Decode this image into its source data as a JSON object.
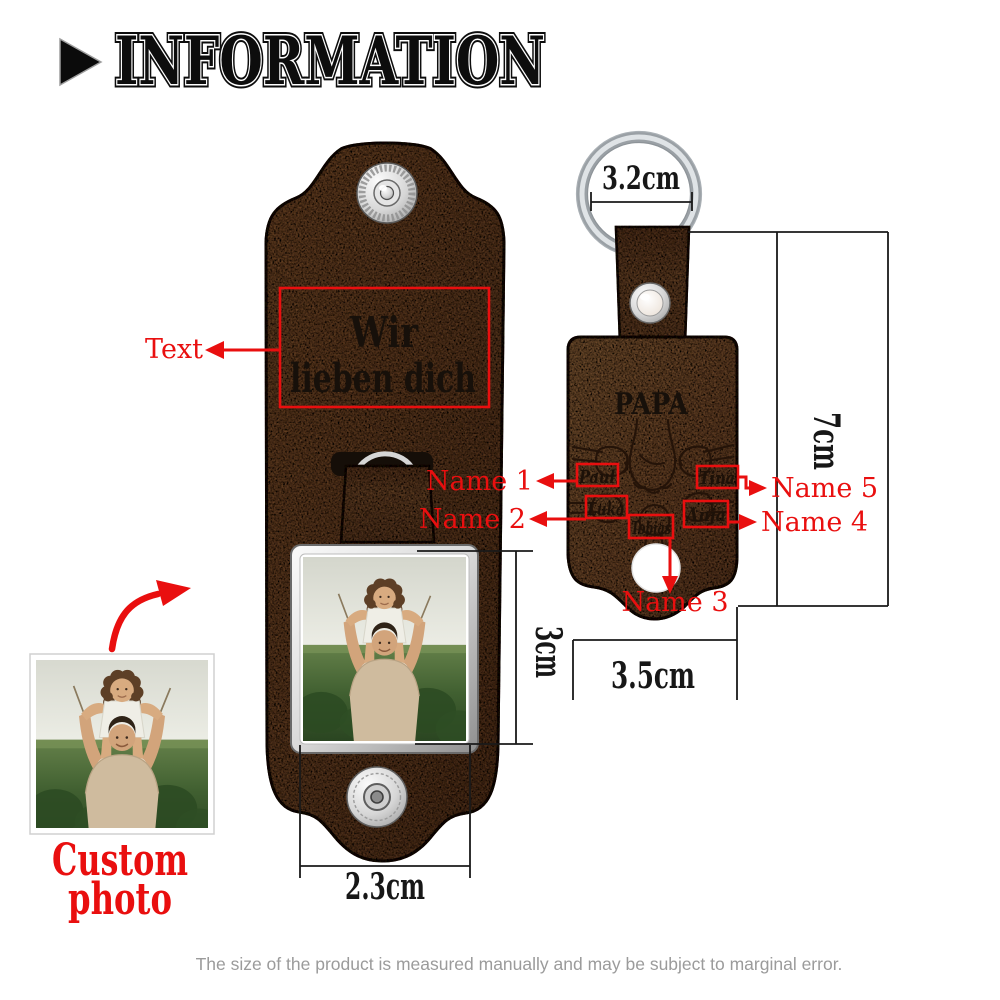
{
  "header": {
    "title": "INFORMATION"
  },
  "left_keychain": {
    "engraved_text": {
      "line1": "Wir",
      "line2": "lieben dich"
    },
    "annotations": {
      "text_label": "Text",
      "custom_photo_line1": "Custom",
      "custom_photo_line2": "photo"
    },
    "dimensions": {
      "photo_height": "3cm",
      "photo_width": "2.3cm"
    }
  },
  "right_keychain": {
    "engraved_title": "PAPA",
    "names": [
      "Paul",
      "Luka",
      "Tobias",
      "Anja",
      "Tina"
    ],
    "annotations": {
      "name1": "Name 1",
      "name2": "Name 2",
      "name3": "Name 3",
      "name4": "Name 4",
      "name5": "Name 5"
    },
    "dimensions": {
      "ring_diameter": "3.2cm",
      "height": "7cm",
      "width": "3.5cm"
    }
  },
  "footer": {
    "disclaimer": "The size of the product is measured manually and may be subject to marginal error."
  },
  "colors": {
    "annotation_red": "#e90f0f",
    "leather_left": "#7a4e2d",
    "leather_right": "#8a5c38",
    "engraving_dark": "#1d1007",
    "metal_silver": "#c9cdd1",
    "dimension_line": "#1a1a1a",
    "disclaimer_gray": "#9b9b9b"
  },
  "icons": {
    "header_marker": "play-triangle-icon"
  }
}
